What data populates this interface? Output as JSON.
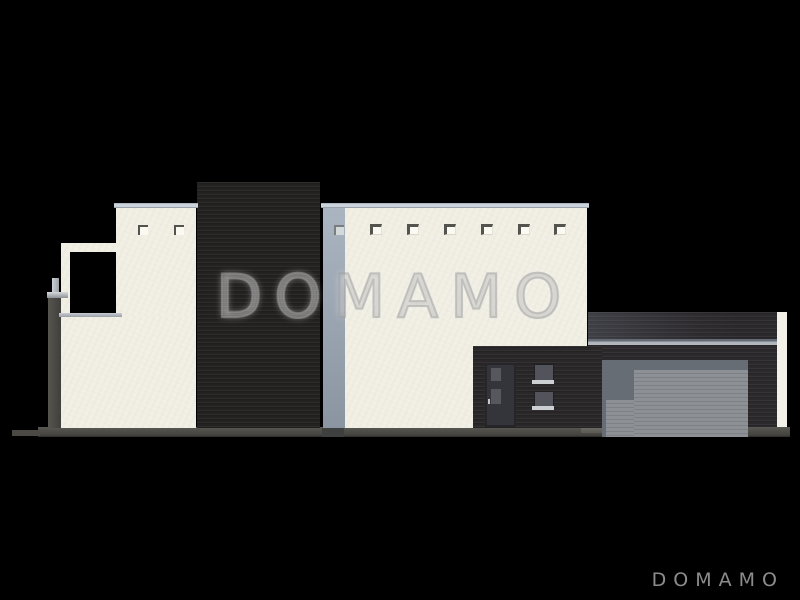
{
  "watermark": {
    "text": "DOMAMO"
  },
  "footer": {
    "brand_text": "DOMAMO",
    "color": "#8c8c8c"
  },
  "palette": {
    "background": "#000000",
    "wall_cream": "#f2f0e5",
    "coping_gray": "#ccd3da",
    "dark_cladding": "#242221",
    "garage_door_gray": "#868a8f",
    "garage_stripe_band": "#adb2b8",
    "ground_gray": "#504f4a",
    "window_pane_gray": "#55565c",
    "logo_gray": "#8c8c8c"
  },
  "scene": {
    "kind": "house-side-elevation-render",
    "vent_count_left_wall": 2,
    "vent_count_main_wall": 7,
    "entry_door_count": 1,
    "garage_door_count": 1
  }
}
